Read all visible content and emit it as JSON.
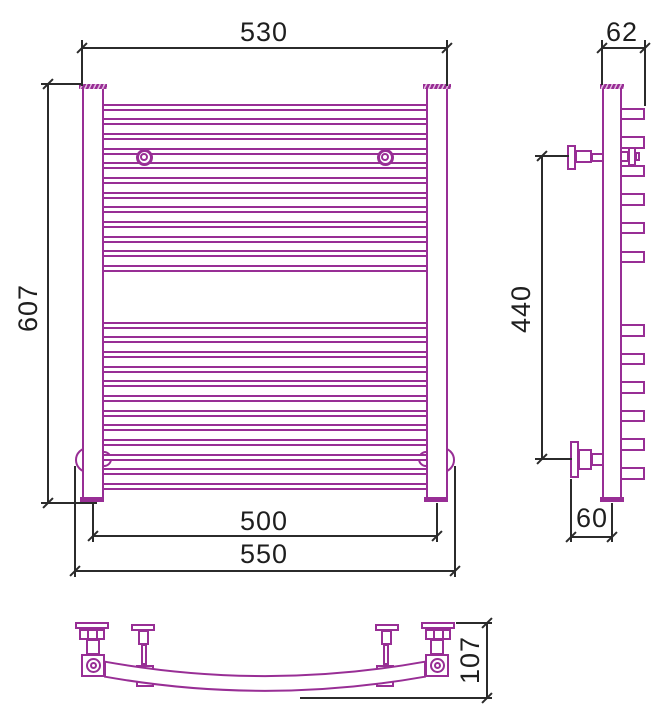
{
  "drawing": {
    "type": "technical-drawing",
    "subject": "ladder towel radiator with curved shelf — front, side and bottom orthographic views",
    "colors": {
      "outline": "#982e95",
      "dimension_lines": "#2b2b2b",
      "background": "#ffffff"
    },
    "front_view": {
      "rungs_upper": 12,
      "rungs_lower": 12,
      "dim_top_width": "530",
      "dim_height": "607",
      "dim_center_width": "500",
      "dim_overall_width": "550"
    },
    "side_view": {
      "loops_upper": 6,
      "loops_lower": 6,
      "dim_depth": "62",
      "dim_bracket_height": "440",
      "dim_wall_to_axis": "60"
    },
    "bottom_view": {
      "dim_depth": "107"
    }
  }
}
